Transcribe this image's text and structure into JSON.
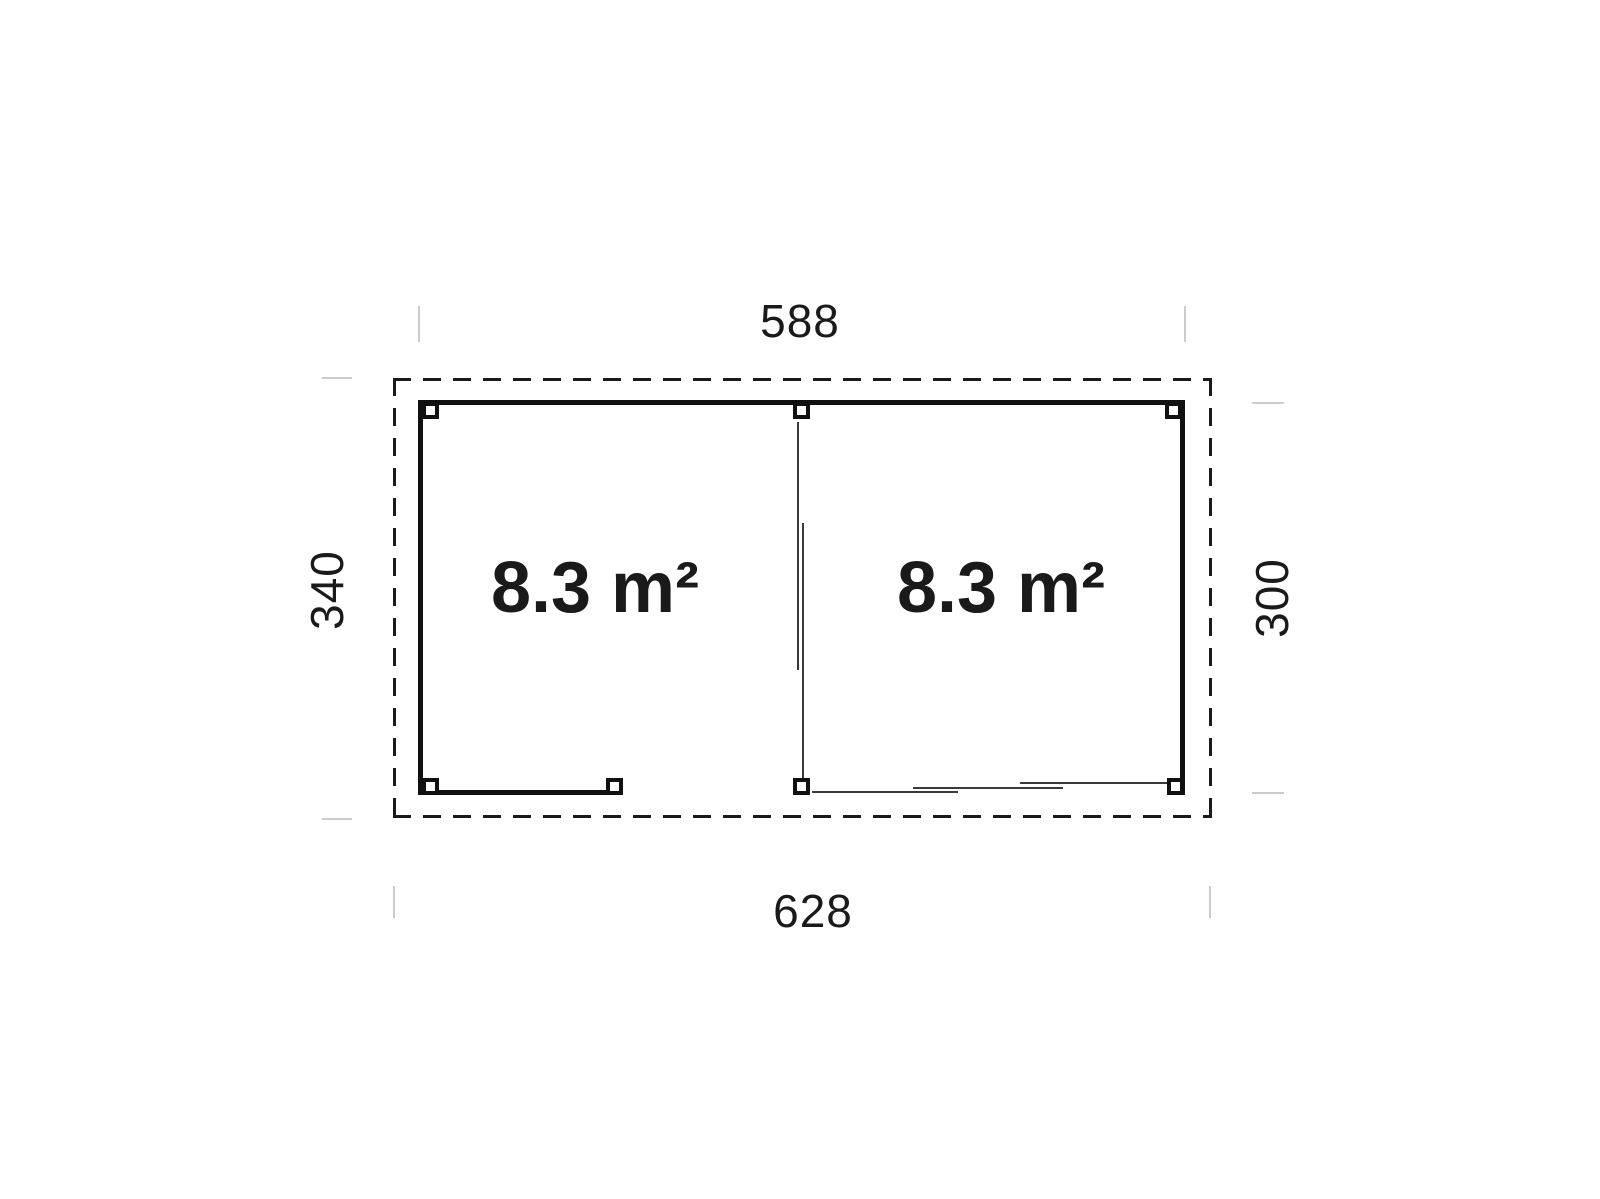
{
  "floor_plan": {
    "rooms": [
      {
        "name": "left-room",
        "area_label": "8.3 m²"
      },
      {
        "name": "right-room",
        "area_label": "8.3 m²"
      }
    ],
    "dimensions": {
      "top_width": "588",
      "bottom_width": "628",
      "left_depth": "340",
      "right_depth": "300"
    },
    "colors": {
      "outline": "#1a1a1a",
      "wall": "#111111",
      "thin_line": "#3a3a3a",
      "extension_line": "#cccccc",
      "background": "#ffffff"
    }
  }
}
